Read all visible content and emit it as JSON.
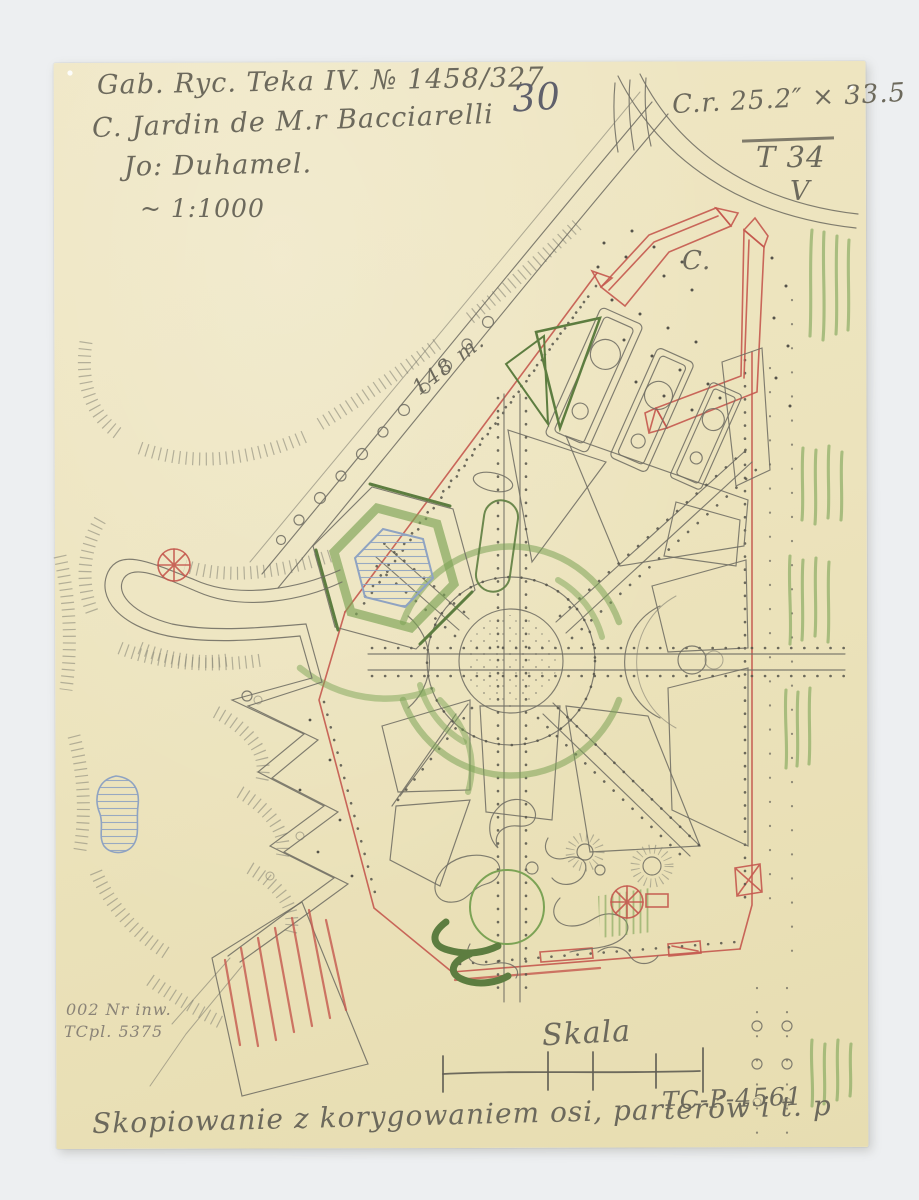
{
  "document": {
    "kind": "scanned hand-drawn garden plan",
    "inscriptions": {
      "archive_ref": "Gab. Ryc. Teka IV. № 1458/327",
      "title": "C. Jardin de M.r Bacciarelli",
      "author": "Jo: Duhamel.",
      "scale_note": "~ 1:1000",
      "page_number": "30",
      "sheet_size": "C.r. 25.2″ × 33.5",
      "portfolio": "T 34",
      "check_mark": "V",
      "section_label": "C.",
      "distance_label": "148 m.",
      "inventory_line1": "002 Nr inw.",
      "inventory_line2": "TCpl. 5375",
      "scale_caption": "Skala",
      "catalog_number": "TC-P-4561",
      "bottom_note": "Skopiowanie z korygowaniem osi, parterów i t. p"
    },
    "colors": {
      "backdrop": "#edeff1",
      "paper": "#ece3bc",
      "pencil": "#6f6d63",
      "red_crayon": "#c4584e",
      "green_crayon": "#7ca355",
      "blue_crayon": "#8fa3c2",
      "ink_text": "#6c695c"
    }
  }
}
